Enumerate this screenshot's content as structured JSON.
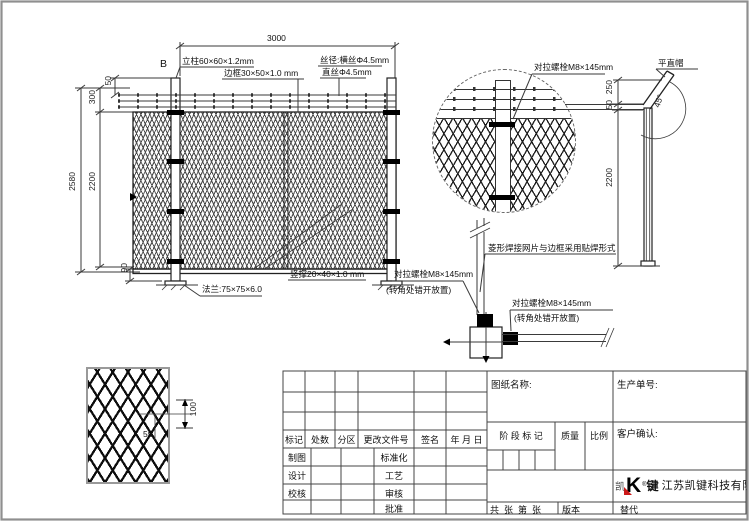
{
  "colors": {
    "line": "#3a3a3a",
    "logo_red": "#cc1a1a"
  },
  "front_view": {
    "dim_width": "3000",
    "dim_total_height": "2580",
    "dim_mesh_height": "2200",
    "dim_top_section": "300",
    "dim_wire_spacing": "50",
    "dim_bottom_gap": "90",
    "detail_marker": "B",
    "post_label": "立柱60×60×1.2mm",
    "frame_label": "边框30×50×1.0 mm",
    "wire_label": "丝径:横丝Φ4.5mm",
    "straight_wire_label": "直丝Φ4.5mm",
    "flange_label": "法兰:75×75×6.0",
    "brace_label": "竖撑20×40×1.0 mm"
  },
  "detail_circle": {
    "bolt_label": "对拉螺栓M8×145mm"
  },
  "section_view": {
    "bolt_label_left": "对拉螺栓M8×145mm",
    "bolt_note_left": "(转角处错开放置)",
    "weld_note": "菱形焊接网片与边框采用贴焊形式",
    "bolt_label_right": "对拉螺栓M8×145mm",
    "bolt_note_right": "(转角处错开放置)"
  },
  "side_view": {
    "cap_label": "平直帽",
    "angle_label": "45°",
    "dim_arm": "250",
    "dim_wire_gap": "50",
    "dim_post_height": "2200"
  },
  "mesh_detail": {
    "dim_height": "100",
    "dim_width": "55"
  },
  "title_block": {
    "drawing_name_label": "图纸名称:",
    "production_order_label": "生产单号:",
    "rev_headers": {
      "mark": "标记",
      "count": "处数",
      "zone": "分区",
      "change_doc": "更改文件号",
      "signature": "签名",
      "date": "年 月 日"
    },
    "stage_mark_label": "阶 段 标 记",
    "weight_label": "质量",
    "scale_label": "比例",
    "customer_confirm_label": "客户确认:",
    "roles": {
      "draft": "制图",
      "design": "设计",
      "check": "校核",
      "standardize": "标准化",
      "process": "工艺",
      "review": "审核",
      "approve": "批准"
    },
    "sheet_count_label": "共  张  第  张",
    "version_label": "版本",
    "substitute_label": "替代",
    "logo": {
      "left_char": "凯",
      "k": "K",
      "reg": "®",
      "right_char": "键",
      "company": "江苏凯键科技有限公司"
    }
  }
}
